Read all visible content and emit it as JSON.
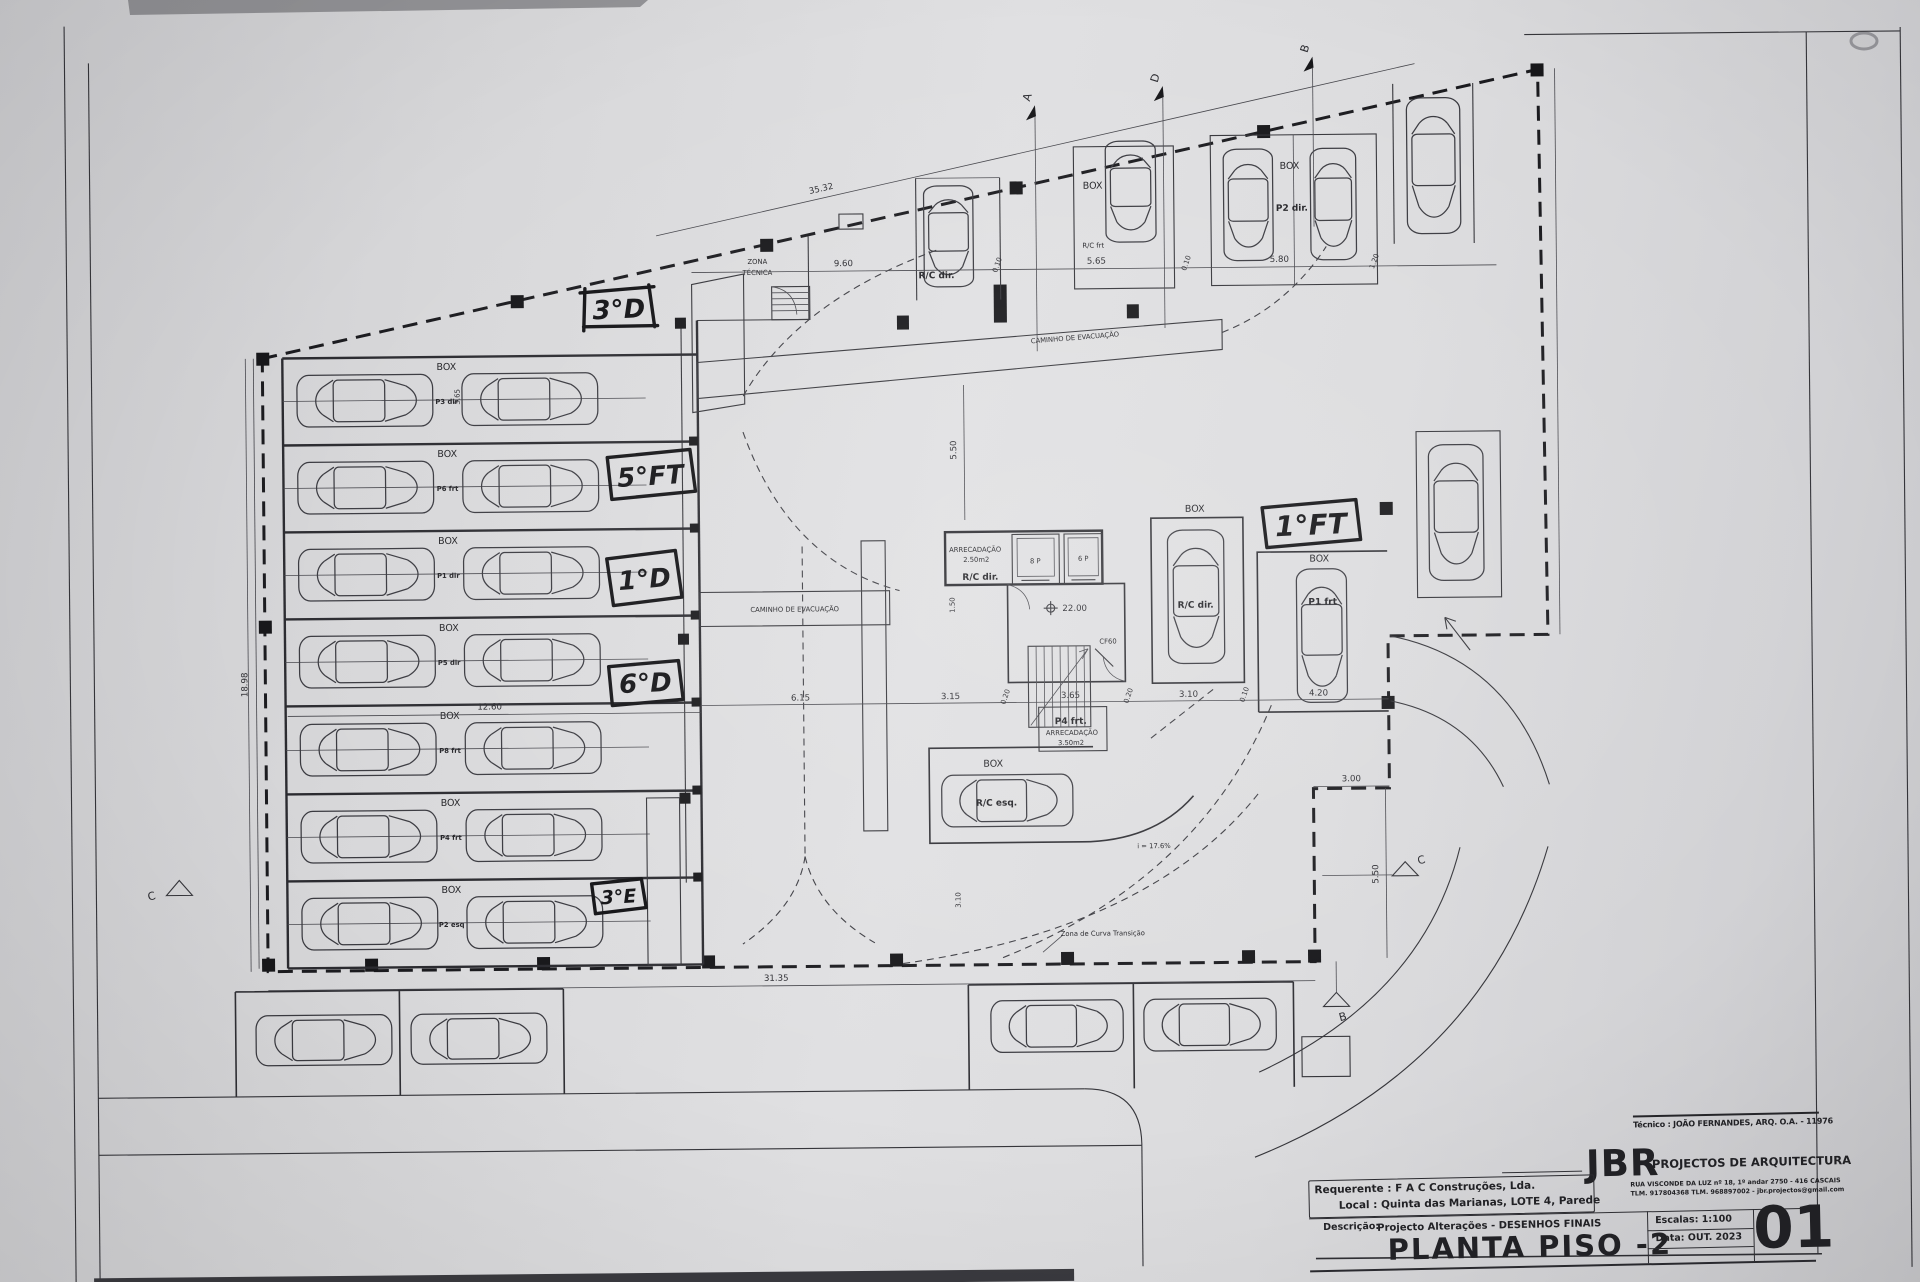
{
  "labels": {
    "box": "BOX",
    "zona_tecnica_1": "ZONA",
    "zona_tecnica_2": "TÉCNICA",
    "caminho": "CAMINHO DE EVACUAÇÃO",
    "curva": "Zona de Curva Transição",
    "slope": "i = 17.6%",
    "arrecadacao": "ARRECADAÇÃO",
    "area_250": "2.50m2",
    "area_350": "3.50m2",
    "rc_dir": "R/C dir.",
    "rc_frt": "R/C frt",
    "rc_esq": "R/C esq.",
    "p2_dir": "P2 dir.",
    "p1_frt": "P1 frt",
    "p4_frt": "P4 frt.",
    "lift_8p": "8 P",
    "lift_6p": "6 P",
    "level": "22.00",
    "door_cf60": "CF60"
  },
  "rows": [
    {
      "p": "P3 dir"
    },
    {
      "p": "P6 frt"
    },
    {
      "p": "P1 dir"
    },
    {
      "p": "P5 dir"
    },
    {
      "p": "P8 frt"
    },
    {
      "p": "P4 frt"
    },
    {
      "p": "P2 esq"
    }
  ],
  "notes": {
    "n3d": "3°D",
    "n5ft": "5°FT",
    "n1d": "1°D",
    "n6d": "6°D",
    "n3e": "3°E",
    "n1ft": "1°FT"
  },
  "dims": {
    "d3532": "35.32",
    "d960": "9.60",
    "d565": "5.65",
    "d580": "5.80",
    "d120": "1.20",
    "d010": "0.10",
    "d1898": "18.98",
    "d3135": "31.35",
    "d1260": "12.60",
    "d615": "6.15",
    "d315": "3.15",
    "d020": "0.20",
    "d365": "3.65",
    "d310": "3.10",
    "d420": "4.20",
    "d300": "3.00",
    "d550": "5.50",
    "d150": "1.50"
  },
  "sections": {
    "a": "A",
    "b": "B",
    "c": "C",
    "d": "D"
  },
  "titleblock": {
    "tecnico": "Técnico : JOÃO FERNANDES, ARQ.  O.A. - 11976",
    "firm_initials": "JBR",
    "firm_name": "PROJECTOS DE ARQUITECTURA",
    "firm_addr1": "RUA VISCONDE DA LUZ nº 18, 1º andar  2750 - 416  CASCAIS",
    "firm_addr2": "TLM. 917804368 TLM. 968897002 - jbr.projectos@gmail.com",
    "requerente": "Requerente : F A C  Construções, Lda.",
    "local": "Local : Quinta das Marianas, LOTE 4, Parede",
    "descricao_label": "Descrição:",
    "descricao": "Projecto Alterações - DESENHOS FINAIS",
    "title": "PLANTA PISO -2",
    "escalas": "Escalas:  1:100",
    "data": "Data: OUT.  2023",
    "sheet": "01"
  }
}
